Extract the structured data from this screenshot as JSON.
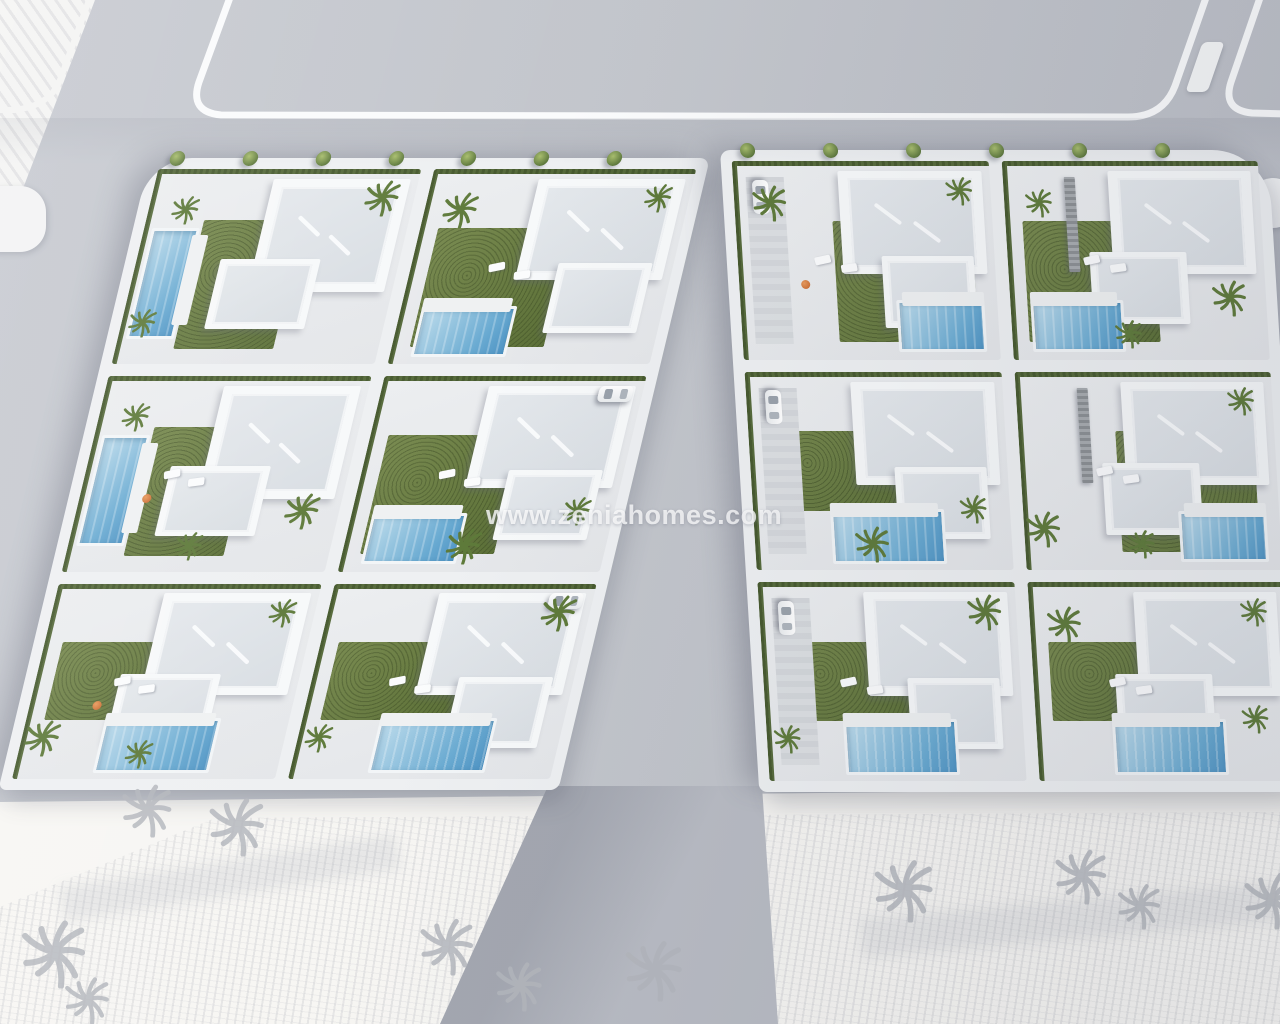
{
  "watermark": "www.zeniahomes.com",
  "scene": {
    "type": "architectural-3d-aerial-render",
    "description": "Bird's-eye 3D visualization of a new-build residential development: two urban blocks of modern white flat-roof villas with private pools, lawned gardens, palm trees and parked cars, bounded by grey asphalt roads with white kerbs; undeveloped white parcels with sketch palm trees at the top-left and bottom"
  },
  "palette": {
    "road": "#c3c6cc",
    "road_lower": "#b9bcc4",
    "kerb": "#fafbfc",
    "sidewalk": "#eef0f2",
    "villa_wall": "#f7f9fa",
    "villa_roof": "#dfe3e8",
    "grass": "#66783f",
    "hedge": "#4c5f31",
    "pool_light": "#bedcec",
    "pool_deep": "#4f94c4",
    "land": "#f7f6f3",
    "sketch_tree": "#b4b7bd",
    "accent_orange": "#c4632a"
  },
  "blocks": [
    {
      "id": "left-block",
      "border_trees": 7,
      "villas": [
        {
          "id": "L1",
          "pool": "left",
          "car": null,
          "palms": 3,
          "lounge": false,
          "accent": false,
          "feature_wall": false
        },
        {
          "id": "L2",
          "pool": "bottom-left",
          "car": null,
          "palms": 2,
          "lounge": true,
          "accent": false,
          "feature_wall": false
        },
        {
          "id": "L3",
          "pool": "left",
          "car": null,
          "palms": 3,
          "lounge": true,
          "accent": true,
          "feature_wall": false
        },
        {
          "id": "L4",
          "pool": "bottom-left",
          "car": "top-right",
          "palms": 2,
          "lounge": true,
          "accent": false,
          "feature_wall": false
        },
        {
          "id": "L5",
          "pool": "bottom",
          "car": null,
          "palms": 3,
          "lounge": true,
          "accent": true,
          "feature_wall": false
        },
        {
          "id": "L6",
          "pool": "bottom",
          "car": "top-right",
          "palms": 2,
          "lounge": true,
          "accent": false,
          "feature_wall": false
        }
      ]
    },
    {
      "id": "right-block",
      "border_trees": 6,
      "villas": [
        {
          "id": "R1",
          "pool": "bottom-right",
          "car": "left",
          "palms": 2,
          "lounge": true,
          "accent": true,
          "feature_wall": false
        },
        {
          "id": "R2",
          "pool": "bottom-left",
          "car": null,
          "palms": 3,
          "lounge": true,
          "accent": false,
          "feature_wall": true
        },
        {
          "id": "R3",
          "pool": "bottom",
          "car": "left",
          "palms": 2,
          "lounge": false,
          "accent": false,
          "feature_wall": false
        },
        {
          "id": "R4",
          "pool": "bottom-right",
          "car": null,
          "palms": 3,
          "lounge": true,
          "accent": false,
          "feature_wall": true
        },
        {
          "id": "R5",
          "pool": "bottom",
          "car": "left",
          "palms": 2,
          "lounge": true,
          "accent": false,
          "feature_wall": false
        },
        {
          "id": "R6",
          "pool": "bottom",
          "car": null,
          "palms": 3,
          "lounge": true,
          "accent": false,
          "feature_wall": false
        }
      ]
    }
  ],
  "land": {
    "sketch_palm_count": 11
  }
}
